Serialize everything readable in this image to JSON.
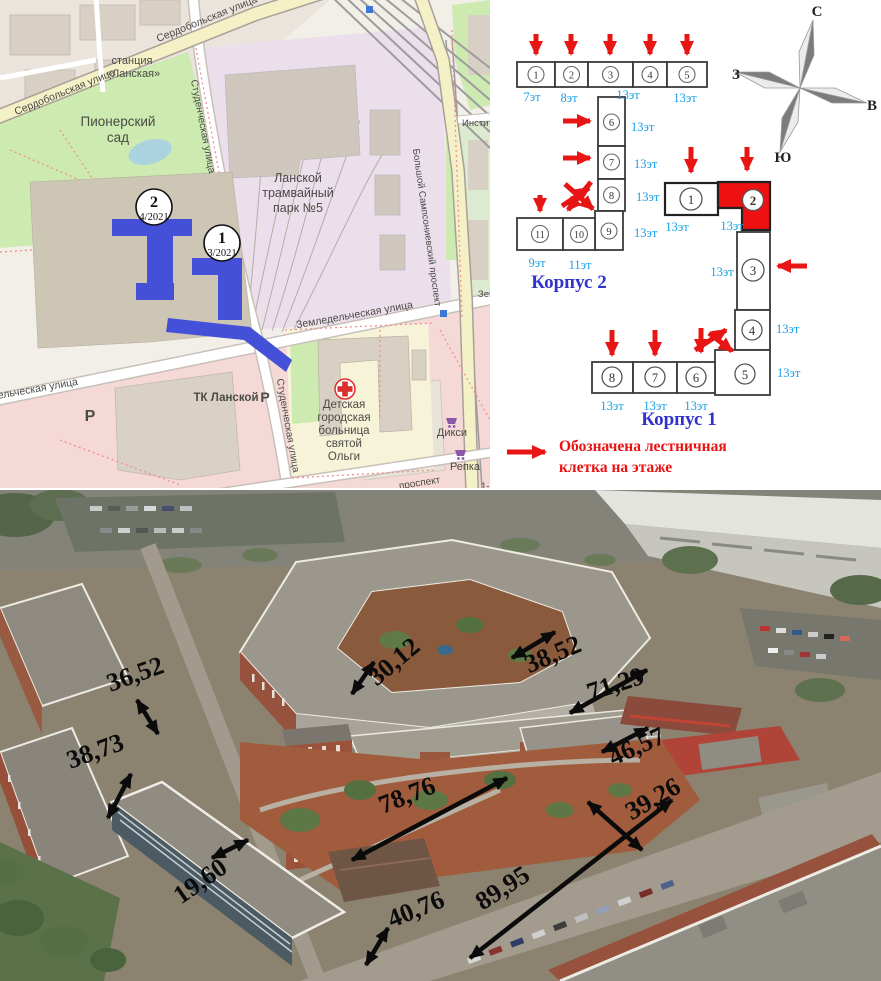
{
  "map": {
    "station": [
      "станция",
      "«Ланская»"
    ],
    "park": [
      "Пионерский",
      "сад"
    ],
    "tram_park": [
      "Ланской",
      "трамвайный",
      "парк №5"
    ],
    "streets": {
      "serdobolskaya": "Сердобольская улица",
      "studencheskaya": "Студенческая улица",
      "zemledelcheskaya": "Земледельческая улица",
      "sampsonievsky": "Большой Сампсониевский проспект",
      "institutsky": "Институт",
      "prospekt": "проспект",
      "pervy": "1-й"
    },
    "places": {
      "tk_lanskoy": "ТК Ланской",
      "hospital": [
        "Детская",
        "городская",
        "больница",
        "святой",
        "Ольги"
      ],
      "diksi": "Дикси",
      "repka": "Репка",
      "parking": "P",
      "zemle_partial": "Земле"
    },
    "markers": [
      {
        "num": "2",
        "date": "4/2021"
      },
      {
        "num": "1",
        "date": "3/2021"
      }
    ],
    "colors": {
      "building_footprint": "#4450d8",
      "park_green": "#cdebb0",
      "tram_lavender": "#ecdfec"
    }
  },
  "scheme": {
    "korpus2": {
      "title": "Корпус 2",
      "sections": [
        "1",
        "2",
        "3",
        "4",
        "5",
        "6",
        "7",
        "8",
        "9",
        "10",
        "11"
      ],
      "floor_labels": {
        "row": [
          "7эт",
          "8эт",
          "13эт",
          "13эт"
        ],
        "col": [
          "13эт",
          "13эт",
          "13эт",
          "13эт"
        ],
        "bottom": [
          "9эт",
          "11эт"
        ]
      }
    },
    "korpus1": {
      "title": "Корпус 1",
      "sections": [
        "1",
        "2",
        "3",
        "4",
        "5",
        "6",
        "7",
        "8"
      ],
      "floors": [
        "13эт",
        "13эт",
        "13эт",
        "13эт",
        "13эт",
        "13эт",
        "13эт",
        "13эт"
      ]
    },
    "compass": {
      "north": "С",
      "east": "В",
      "south": "Ю",
      "west": "З"
    },
    "legend": [
      "Обозначена лестничная",
      "клетка на этаже"
    ],
    "colors": {
      "highlight_section": "#ee1111",
      "arrow_red": "#e81515",
      "floor_label_blue": "#18a0e8",
      "title_blue": "#3232cc"
    }
  },
  "photo": {
    "dimensions": [
      "36,52",
      "38,73",
      "30,12",
      "38,52",
      "71,29",
      "46,57",
      "39,26",
      "78,76",
      "40,76",
      "89,95",
      "19,60"
    ]
  }
}
